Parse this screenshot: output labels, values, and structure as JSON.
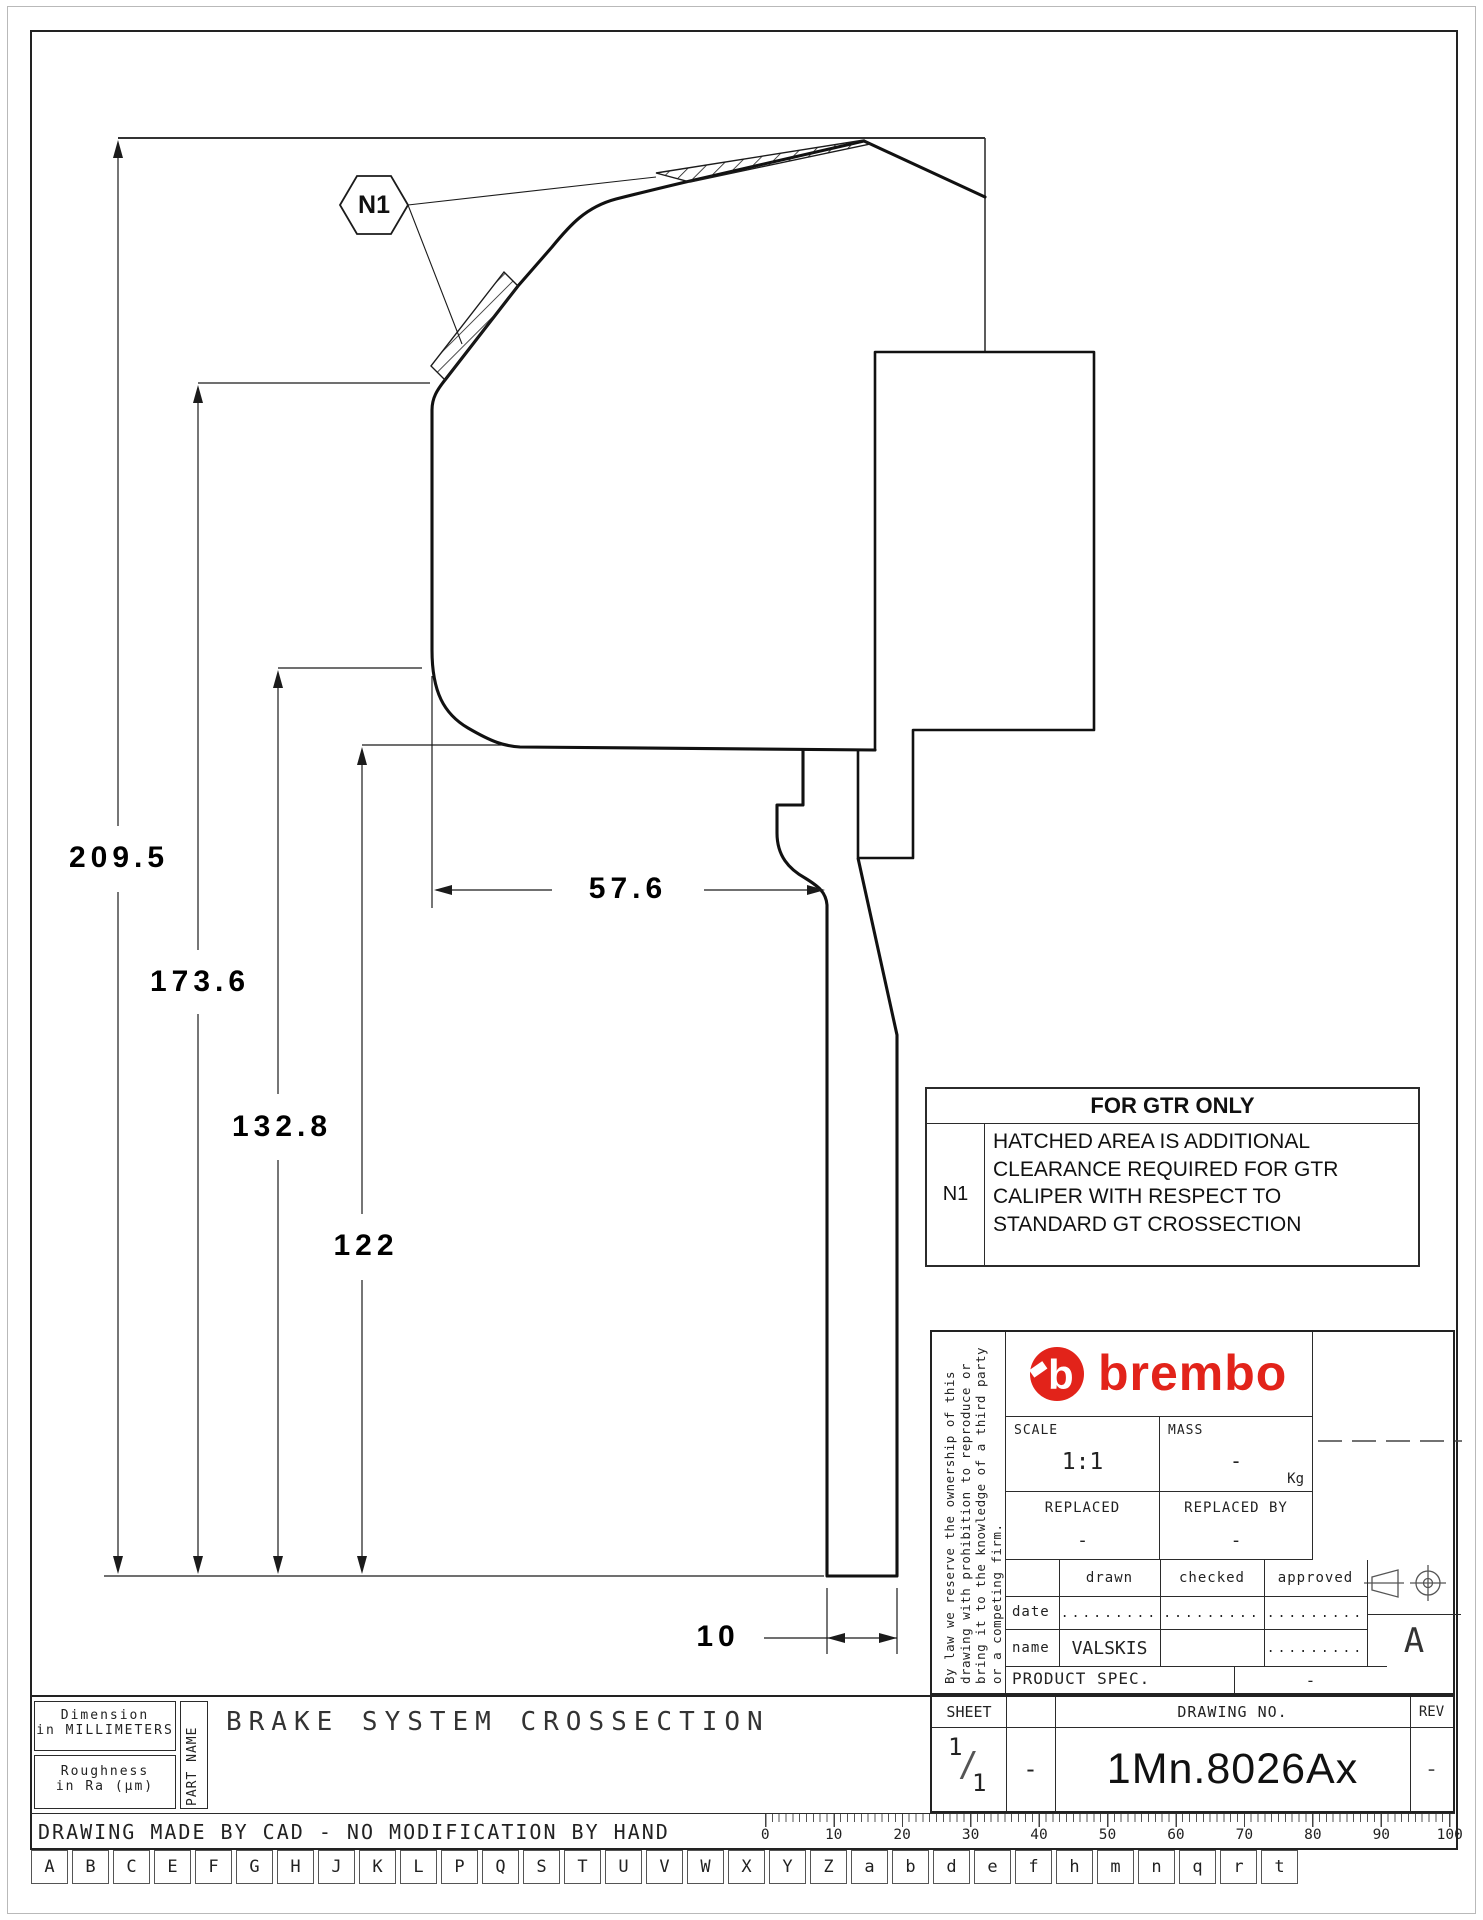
{
  "callout": {
    "ref": "N1"
  },
  "dimensions": {
    "d209": "209.5",
    "d173": "173.6",
    "d132": "132.8",
    "d122": "122",
    "d57": "57.6",
    "d10": "10"
  },
  "note_box": {
    "title": "FOR GTR ONLY",
    "ref": "N1",
    "line1": "HATCHED AREA IS ADDITIONAL",
    "line2": "CLEARANCE REQUIRED FOR GTR",
    "line3": "CALIPER WITH RESPECT TO",
    "line4": "STANDARD GT CROSSECTION"
  },
  "title_block": {
    "brand": "brembo",
    "legal": "By law we reserve the ownership of this drawing with prohibition to reproduce or bring it to the knowledge of a third party or a competing firm.",
    "scale_label": "SCALE",
    "scale_value": "1:1",
    "mass_label": "MASS",
    "mass_value": "-",
    "mass_unit": "Kg",
    "replaced_label": "REPLACED",
    "replaced_value": "-",
    "replaced_by_label": "REPLACED BY",
    "replaced_by_value": "-",
    "drawn_label": "drawn",
    "checked_label": "checked",
    "approved_label": "approved",
    "date_label": "date",
    "name_label": "name",
    "date_drawn": ".........",
    "date_checked": ".........",
    "date_approved": ".........",
    "name_drawn": "VALSKIS",
    "name_checked": "",
    "name_approved": ".........",
    "product_spec_label": "PRODUCT SPEC.",
    "product_spec_value": "-",
    "size_letter": "A"
  },
  "doc_block": {
    "sheet_label": "SHEET",
    "sheet_num": "1",
    "sheet_den": "1",
    "sheet_slash": "/",
    "sheet_extra": "-",
    "drawing_no_label": "DRAWING NO.",
    "drawing_no": "1Mn.8026Ax",
    "rev_label": "REV",
    "rev_value": "-"
  },
  "part_block": {
    "dim_line1": "Dimension",
    "dim_line2": "in MILLIMETERS",
    "rough_line1": "Roughness",
    "rough_line2": "in Ra (µm)",
    "part_name_label": "PART NAME",
    "part_name": "BRAKE SYSTEM CROSSECTION"
  },
  "footer": {
    "cad_note": "DRAWING MADE BY CAD - NO MODIFICATION BY HAND",
    "ruler_numbers": [
      "0",
      "10",
      "20",
      "30",
      "40",
      "50",
      "60",
      "70",
      "80",
      "90",
      "100"
    ],
    "letters": [
      "A",
      "B",
      "C",
      "E",
      "F",
      "G",
      "H",
      "J",
      "K",
      "L",
      "P",
      "Q",
      "S",
      "T",
      "U",
      "V",
      "W",
      "X",
      "Y",
      "Z",
      "a",
      "b",
      "d",
      "e",
      "f",
      "h",
      "m",
      "n",
      "q",
      "r",
      "t"
    ]
  },
  "colors": {
    "accent_red": "#e2231a",
    "line": "#1b1b1b"
  }
}
